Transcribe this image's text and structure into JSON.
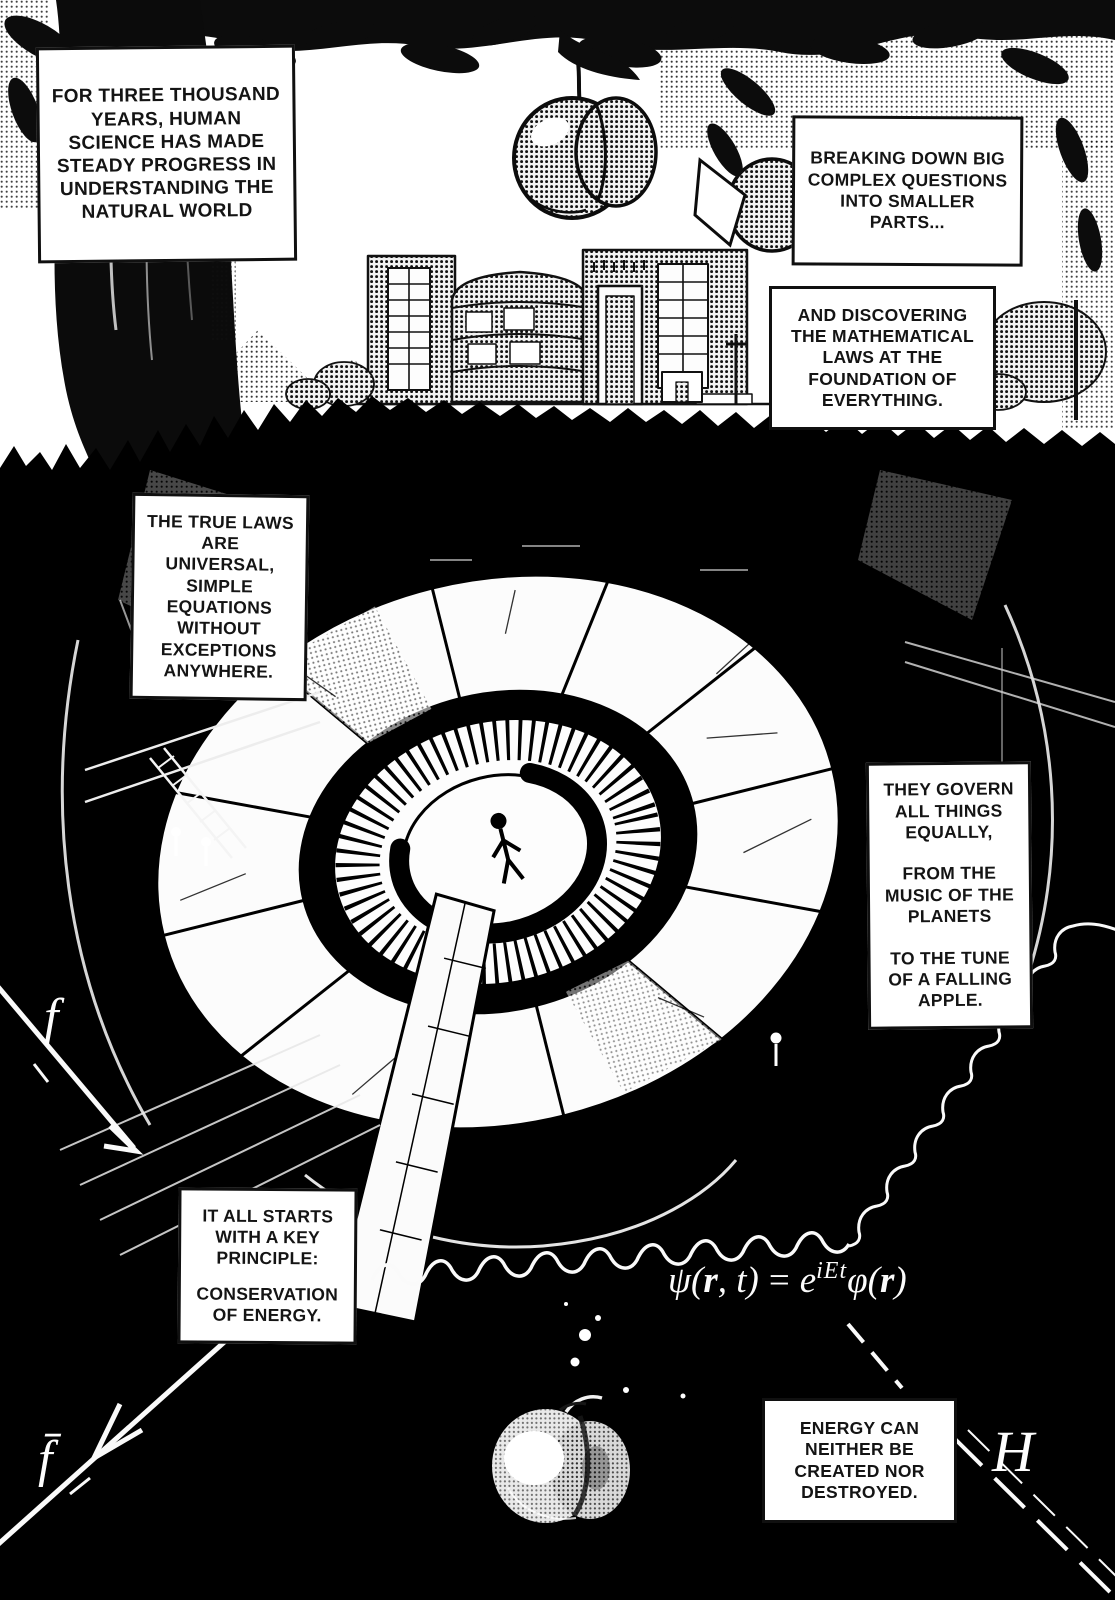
{
  "page": {
    "width": 1115,
    "height": 1600,
    "colors": {
      "ink": "#101010",
      "paper": "#ffffff",
      "pit_background": "#000000"
    }
  },
  "captions": {
    "intro": "FOR THREE THOUSAND YEARS, HUMAN SCIENCE HAS MADE STEADY PROGRESS IN UNDERSTANDING THE NATURAL WORLD",
    "breaking_down": "BREAKING DOWN BIG COMPLEX QUESTIONS INTO SMALLER PARTS...",
    "discovering": "AND DISCOVERING THE MATHEMATICAL LAWS AT THE FOUNDATION OF EVERYTHING.",
    "true_laws": "THE TRUE LAWS ARE UNIVERSAL, SIMPLE EQUATIONS WITHOUT EXCEPTIONS ANYWHERE.",
    "govern": {
      "p1": "THEY GOVERN ALL THINGS EQUALLY,",
      "p2": "FROM THE MUSIC OF THE PLANETS",
      "p3": "TO THE TUNE OF A FALLING APPLE."
    },
    "principle": {
      "p1": "IT ALL STARTS WITH A KEY PRINCIPLE:",
      "p2": "CONSERVATION OF ENERGY."
    },
    "conservation": "ENERGY CAN NEITHER BE CREATED NOR DESTROYED."
  },
  "equation": {
    "lhs_open": "ψ(",
    "lhs_vector": "r",
    "lhs_close": ", t)",
    "equals": "=",
    "base": "e",
    "exponent": "iEt",
    "rhs_open": "φ(",
    "rhs_vector": "r",
    "rhs_close": ")"
  },
  "diagram_labels": {
    "fermion": "f",
    "antifermion": "f̄",
    "higgs": "H"
  }
}
